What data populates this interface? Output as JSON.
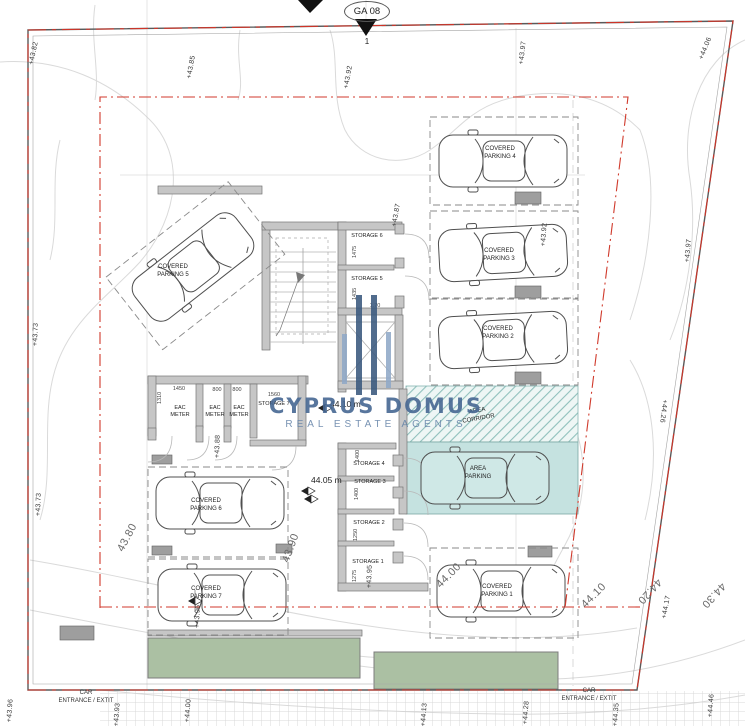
{
  "marker": {
    "ga": "GA 08",
    "point": "1"
  },
  "watermark": {
    "title": "CYPRUS DOMUS",
    "subtitle": "REAL ESTATE AGENTS"
  },
  "levels": {
    "upper": "44.10 m",
    "lower": "44.05 m"
  },
  "parking": {
    "p1": "COVERED\nPARKING 1",
    "p2": "COVERED\nPARKING 2",
    "p3": "COVERED\nPARKING 3",
    "p4": "COVERED\nPARKING 4",
    "p5": "COVERED\nPARKING 5",
    "p6": "COVERED\nPARKING 6",
    "p7": "COVERED\nPARKING 7",
    "area_parking": "AREA\nPARKING",
    "area_corridor": "AREA\nCORRIDOR"
  },
  "rooms": {
    "storage1": "STORAGE 1",
    "storage2": "STORAGE 2",
    "storage3": "STORAGE 3",
    "storage4": "STORAGE 4",
    "storage5": "STORAGE 5",
    "storage6": "STORAGE 6",
    "storage7": "STORAGE 7",
    "meter": "EAC\nMETER"
  },
  "dims": {
    "s6": "1475",
    "s5": "1435",
    "s4": "1400",
    "s3": "1400",
    "s2": "1250",
    "s1": "1275",
    "m1": "1450",
    "m2": "800",
    "m3": "800",
    "s7": "1560",
    "depth": "1310",
    "lift": "1.70"
  },
  "elevations": {
    "e1": "+43.82",
    "e2": "+43.85",
    "e3": "+43.92",
    "e4": "+43.97",
    "e5": "+44.06",
    "e6": "+43.73",
    "e7": "+43.73",
    "e8": "+43.87",
    "e9": "+43.92",
    "e10": "+43.88",
    "e11": "+43.95",
    "e12": "+43.96",
    "e13": "+43.97",
    "e14": "+44.26",
    "e15": "+44.17",
    "e16": "+43.96",
    "e17": "+43.93",
    "e18": "+44.00",
    "e19": "+44.13",
    "e20": "+44.28",
    "e21": "+44.35",
    "e22": "+44.46"
  },
  "contour_labels": {
    "c1": "43.80",
    "c2": "43.90",
    "c3": "44.00",
    "c4": "44.10",
    "c5": "44.20",
    "c6": "44.30"
  },
  "entrance": {
    "left": "CAR\nENTRANCE / EXTIT",
    "right": "CAR\nENTRANCE / EXTIT"
  },
  "colors": {
    "teal_fill": "#c5e2e0",
    "green_fill": "#abc0a3",
    "boundary_red": "#cf3428",
    "watermark_blue": "#46668f"
  }
}
